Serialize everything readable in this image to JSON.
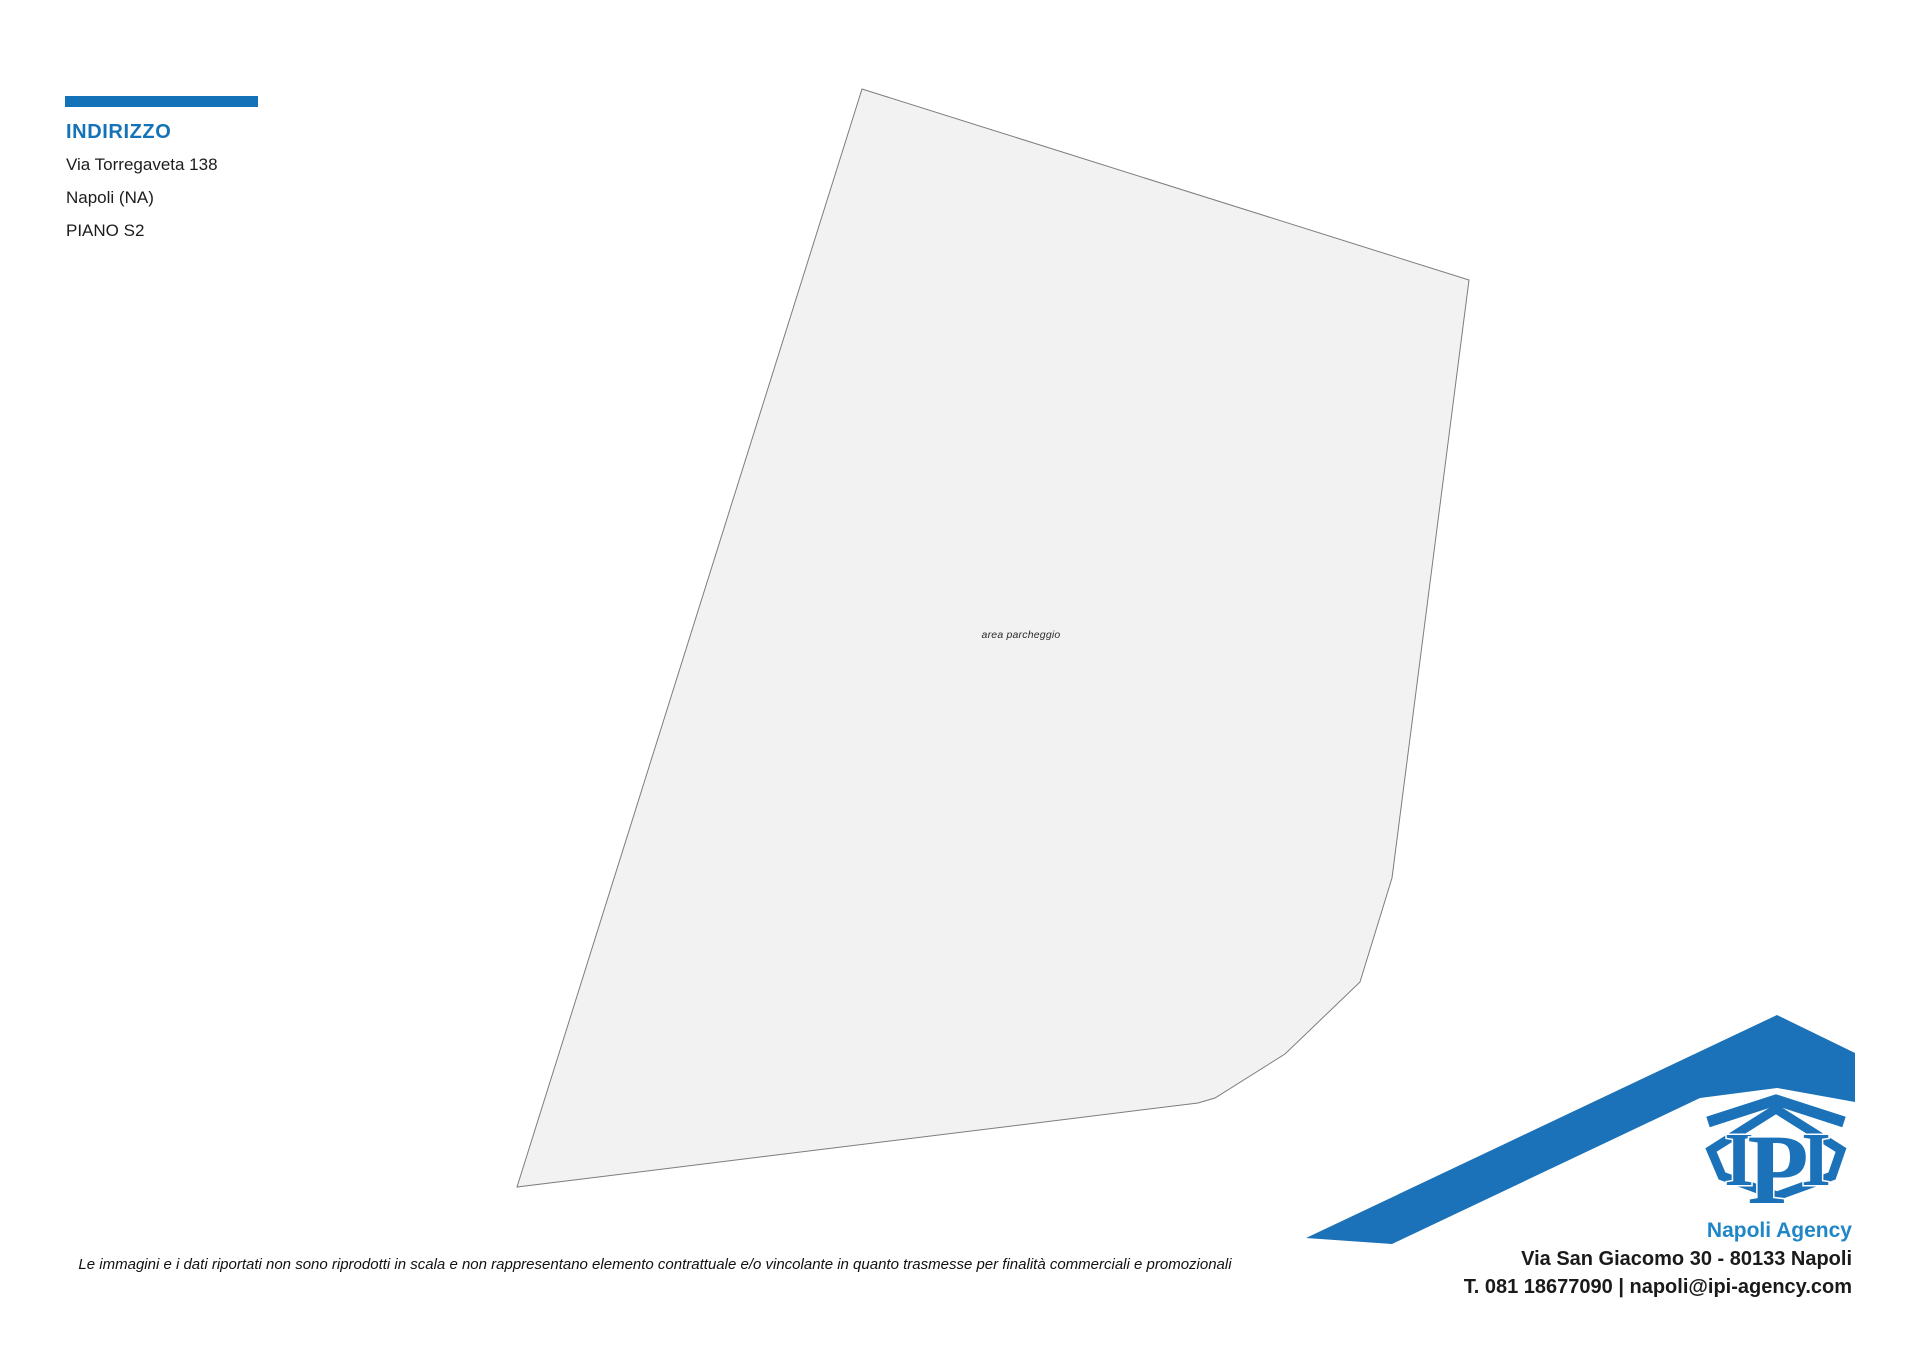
{
  "address_block": {
    "heading": "INDIRIZZO",
    "street": "Via Torregaveta 138",
    "city": "Napoli (NA)",
    "floor": "PIANO S2",
    "accent_color": "#1473b8"
  },
  "floorplan": {
    "label": "area parcheggio",
    "fill": "#f2f2f2",
    "stroke": "#7d7d7d",
    "outline_points": "862,89 1469,280 1392,878 1360,982 1285,1054 1215,1098 1198,1103 517,1187"
  },
  "disclaimer": {
    "text": "Le immagini e i dati riportati non sono riprodotti in scala e non rappresentano elemento contrattuale e/o vincolante in quanto trasmesse per finalità commerciali e promozionali"
  },
  "agency": {
    "name": "Napoli Agency",
    "address": "Via San Giacomo 30 - 80133 Napoli",
    "contact": "T. 081 18677090 | napoli@ipi-agency.com",
    "brand_blue": "#1b72b8",
    "name_color": "#1f86c7",
    "swoosh_points": "1306,1238 1777,1015 1855,1053 1855,1102 1777,1088 1700,1098 1392,1244",
    "chevron_path": "M 1708,1122 L 1776,1100 L 1844,1122",
    "hexagon_points": "1776,1109 1841,1150 1832,1176 1777,1196 1722,1176 1711,1150",
    "logo_letters": {
      "left": "I",
      "mid": "P",
      "right": "I"
    }
  }
}
